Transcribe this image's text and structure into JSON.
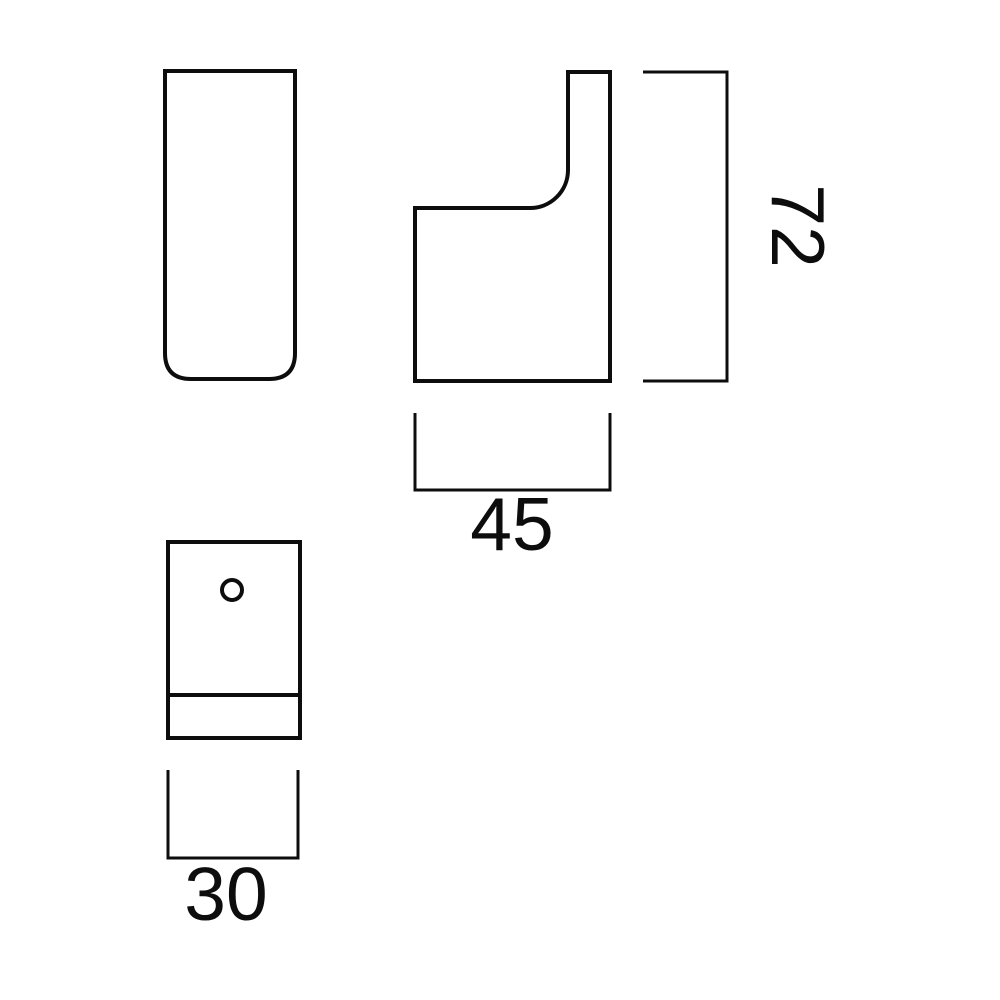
{
  "diagram": {
    "type": "technical-drawing",
    "subject": "wall hook - orthographic views",
    "background_color": "#ffffff",
    "line_color": "#0d0d0d",
    "views": [
      {
        "id": "front-view",
        "shape": "tall rectangle, rounded bottom corners"
      },
      {
        "id": "side-profile-view",
        "shape": "hook profile with concave fillet notch"
      },
      {
        "id": "back-plate-view",
        "shape": "rectangle with screw hole and parting line"
      }
    ],
    "dimensions": [
      {
        "id": "height",
        "label": "72",
        "text_rotation_deg": 90
      },
      {
        "id": "depth",
        "label": "45",
        "text_rotation_deg": 0
      },
      {
        "id": "width",
        "label": "30",
        "text_rotation_deg": 0
      }
    ]
  }
}
